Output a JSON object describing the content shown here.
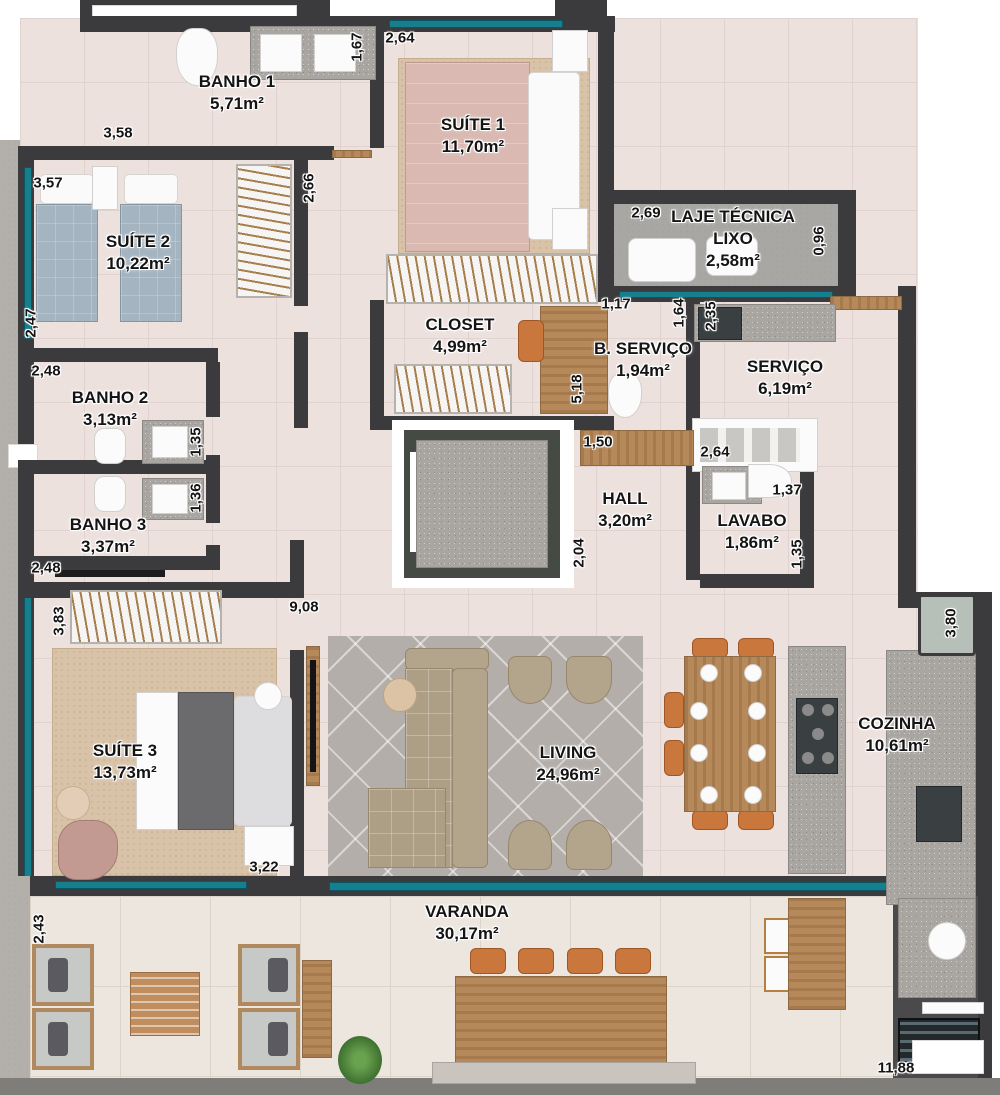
{
  "rooms": {
    "banho1": {
      "name": "BANHO 1",
      "area": "5,71m²"
    },
    "suite1": {
      "name": "SUÍTE 1",
      "area": "11,70m²"
    },
    "suite2": {
      "name": "SUÍTE 2",
      "area": "10,22m²"
    },
    "laje": {
      "name": "LAJE TÉCNICA",
      "line2": "LIXO",
      "area": "2,58m²"
    },
    "closet": {
      "name": "CLOSET",
      "area": "4,99m²"
    },
    "bservico": {
      "name": "B. SERVIÇO",
      "area": "1,94m²"
    },
    "servico": {
      "name": "SERVIÇO",
      "area": "6,19m²"
    },
    "banho2": {
      "name": "BANHO 2",
      "area": "3,13m²"
    },
    "banho3": {
      "name": "BANHO 3",
      "area": "3,37m²"
    },
    "hall": {
      "name": "HALL",
      "area": "3,20m²"
    },
    "lavabo": {
      "name": "LAVABO",
      "area": "1,86m²"
    },
    "suite3": {
      "name": "SUÍTE 3",
      "area": "13,73m²"
    },
    "living": {
      "name": "LIVING",
      "area": "24,96m²"
    },
    "cozinha": {
      "name": "COZINHA",
      "area": "10,61m²"
    },
    "varanda": {
      "name": "VARANDA",
      "area": "30,17m²"
    }
  },
  "dims": {
    "banho1_w": "3,58",
    "banho1_d": "1,67",
    "suite1_w": "2,64",
    "hall_top": "2,66",
    "suite2_w": "3,57",
    "suite2_d": "2,47",
    "banho2_w": "2,48",
    "banho2_d": "1,35",
    "banho3_d": "1,36",
    "banho3_w": "2,48",
    "laje_w": "2,69",
    "laje_d": "0,96",
    "bservico_w": "1,17",
    "bservico_d": "1,64",
    "servico_d": "2,35",
    "closet_d": "5,18",
    "servico_w": "2,64",
    "hall_w": "1,50",
    "hall_d": "2,04",
    "lavabo_w": "1,37",
    "lavabo_d": "1,35",
    "suite3_ward": "3,83",
    "living_l": "9,08",
    "suite3_w": "3,22",
    "cozinha_d": "3,80",
    "varanda_d": "2,43",
    "varanda_w": "11,88"
  },
  "colors": {
    "wall": "#3b3b3d",
    "window_glass": "#157f8d",
    "floor_main": "#ede1de",
    "floor_varanda": "#ece6df",
    "floor_laje": "#a9a7a3",
    "rug_beige": "#d8c3a9",
    "marble_rug": "#b3aeaa",
    "granite": "#a9a5a1",
    "wood": "#b5895a",
    "bed_pink": "#d9b9b1",
    "bed_blue": "#a4b4c0",
    "sofa_taupe": "#b3a48c",
    "chair_orange": "#c9773c",
    "label_text": "#141414"
  }
}
